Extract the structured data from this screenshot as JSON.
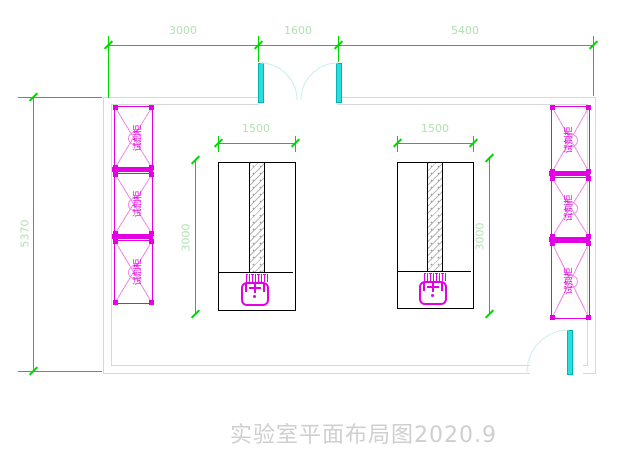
{
  "title": "实验室平面布局图2020.9",
  "dims": {
    "top_segments": [
      "3000",
      "1600",
      "5400"
    ],
    "overall_height": "5370"
  },
  "benches": [
    {
      "width_label": "1500",
      "depth_label": "3000"
    },
    {
      "width_label": "1500",
      "depth_label": "3000"
    }
  ],
  "cabinets": {
    "left": [
      "试剂柜",
      "试剂柜",
      "试剂柜"
    ],
    "right": [
      "试剂柜",
      "试剂柜",
      "试剂柜"
    ]
  },
  "colors": {
    "dim-line": "#00d600",
    "dim-text": "#b2e2b2",
    "magenta": "#e400e4",
    "pink": "#f08ae8",
    "cyan": "#2adede",
    "arc": "#c8eef0",
    "wall": "#d8d8d8",
    "bench": "#000000",
    "title": "#cfcfcf"
  }
}
